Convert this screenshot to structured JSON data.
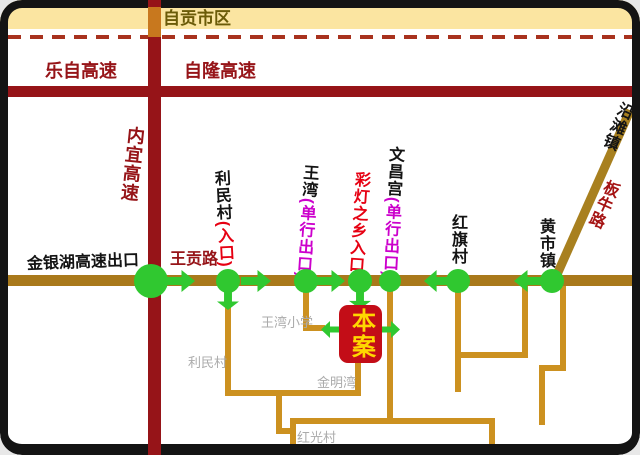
{
  "colors": {
    "highway_red": "#961418",
    "local_gold": "#CC9120",
    "trunk_gold": "#A9791B",
    "diagonal_gold": "#A8801F",
    "city_band": "#FBE5A1",
    "flow_green": "#30C830",
    "site_red": "#C30D17",
    "site_text": "#FFD700",
    "magenta": "#CC00CC",
    "red_text": "#E60012",
    "gray_text": "#ABABAB",
    "frame_black": "#141414"
  },
  "header": {
    "city_area": "自贡市区"
  },
  "highways": {
    "lezi": "乐自高速",
    "zilong": "自隆高速",
    "neiyi": "内宜高速"
  },
  "roads": {
    "wanggong": "王贡路",
    "banniu": "板牛路"
  },
  "towns": {
    "yantan": "沿滩镇",
    "huangshi": "黄市镇"
  },
  "exits": {
    "jinyinhu": "金银湖高速出口"
  },
  "stops": {
    "limin": {
      "name": "利民村",
      "tag": "(入口)"
    },
    "wangwan": {
      "name": "王湾",
      "tag": "(单行出口)"
    },
    "caideng": {
      "name": "彩灯之乡入口"
    },
    "wenchang": {
      "name": "文昌宫",
      "tag": "(单行出口)"
    },
    "hongqi": {
      "name": "红旗村"
    }
  },
  "places": {
    "school": "王湾小学",
    "limin_village": "利民村",
    "jinmingwan": "金明湾",
    "hongguang": "红光村"
  },
  "site": {
    "label": "本案"
  }
}
